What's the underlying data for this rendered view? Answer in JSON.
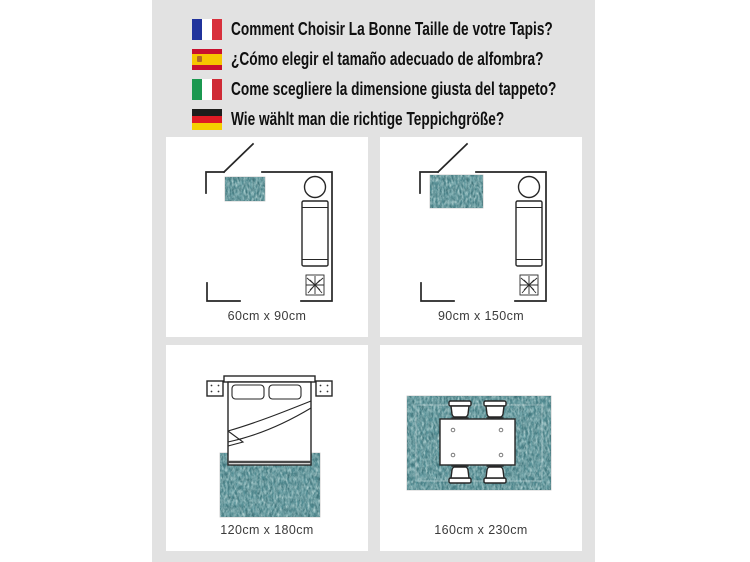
{
  "header": {
    "questions": [
      {
        "icon": "flag-france-icon",
        "lang": "fr",
        "text": "Comment Choisir La Bonne Taille de votre Tapis?"
      },
      {
        "icon": "flag-spain-icon",
        "lang": "es",
        "text": "¿Cómo elegir el tamaño adecuado de alfombra?"
      },
      {
        "icon": "flag-italy-icon",
        "lang": "it",
        "text": "Come scegliere la dimensione giusta del tappeto?"
      },
      {
        "icon": "flag-germany-icon",
        "lang": "de",
        "text": "Wie wählt man die richtige Teppichgröße?"
      }
    ]
  },
  "panels": [
    {
      "type": "bedroom-floorplan-small-rug",
      "label": "60cm x 90cm"
    },
    {
      "type": "bedroom-floorplan-medium-rug",
      "label": "90cm x 150cm"
    },
    {
      "type": "bed-top-view-rug",
      "label": "120cm x 180cm"
    },
    {
      "type": "dining-table-top-view-rug",
      "label": "160cm x 230cm"
    }
  ],
  "colors": {
    "bg_gray": "#e2e2e2",
    "rug_base": "#3f7278",
    "line": "#262626",
    "header_text": "#101010",
    "label_text": "#3b3b3b",
    "flag_fr_blue": "#20339c",
    "flag_fr_red": "#d8303c",
    "flag_es_red": "#c8102e",
    "flag_es_yellow": "#f6c500",
    "flag_it_green": "#1b9850",
    "flag_it_red": "#cf2b36",
    "flag_de_black": "#1d1d1b",
    "flag_de_red": "#df1b24",
    "flag_de_gold": "#f5cf00"
  }
}
